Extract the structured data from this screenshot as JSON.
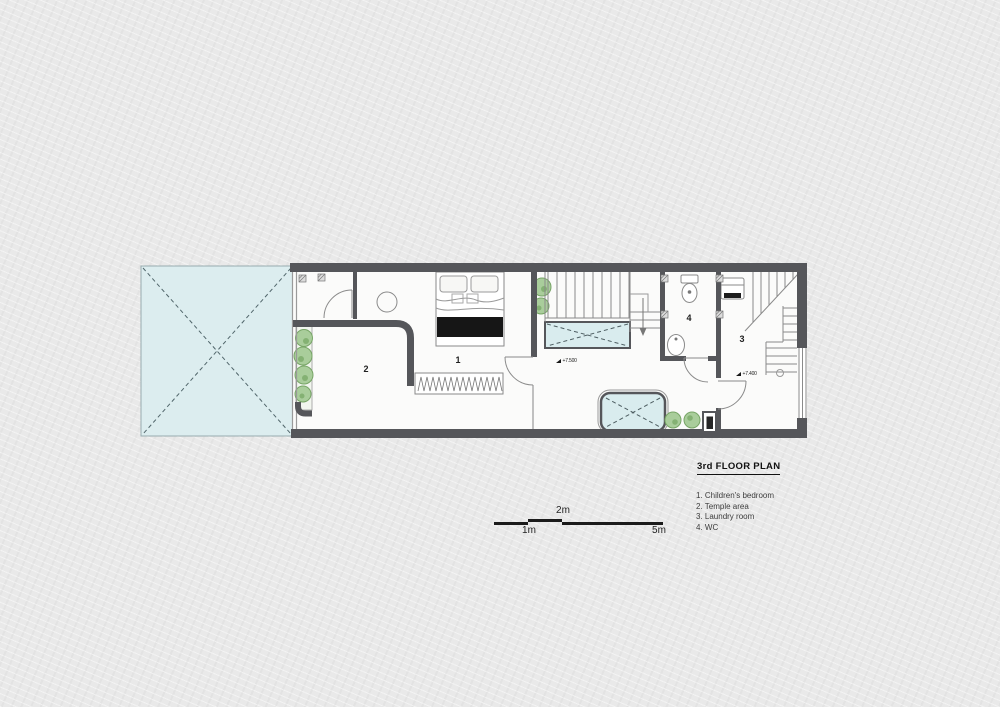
{
  "title_block": {
    "title": "3rd FLOOR PLAN",
    "legend": [
      "1. Children's bedroom",
      "2. Temple area",
      "3. Laundry room",
      "4. WC"
    ]
  },
  "plan": {
    "room_labels": [
      {
        "room": "children-bedroom",
        "text": "1"
      },
      {
        "room": "temple-area",
        "text": "2"
      },
      {
        "room": "laundry-room",
        "text": "3"
      },
      {
        "room": "wc",
        "text": "4"
      }
    ],
    "level_markers": [
      {
        "text": "+7.500"
      },
      {
        "text": "+7.400"
      }
    ]
  },
  "scale_bar": {
    "labels": [
      "2m",
      "1m",
      "5m"
    ]
  },
  "colors": {
    "wall": "#55565a",
    "skylight_fill": "#dcedef",
    "plant_fill": "#a9cd9b",
    "plant_accent": "#7fae6d",
    "paper": "#e9e9e9",
    "thin_line": "#8a8a8a",
    "black_fixture": "#161616"
  }
}
